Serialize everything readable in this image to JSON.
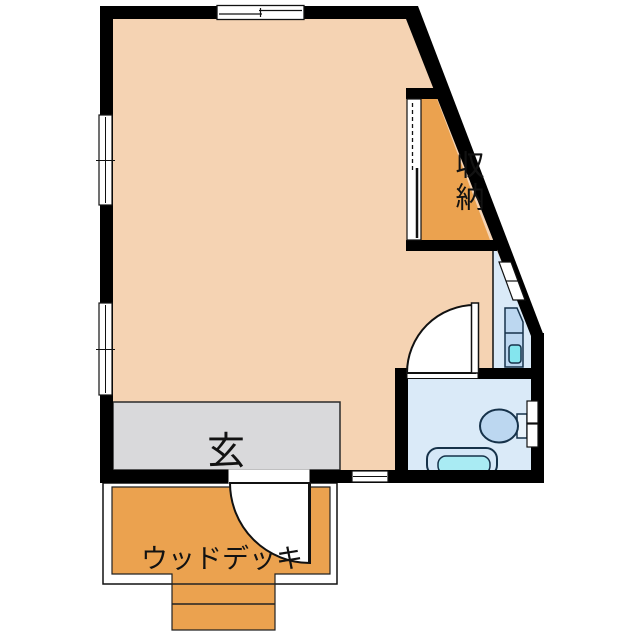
{
  "document": {
    "type": "floor-plan"
  },
  "labels": {
    "storage": "収納",
    "entrance": "玄",
    "wood_deck": "ウッドデッキ"
  },
  "colors": {
    "wall": "#000000",
    "outline": "#111111",
    "main_room": "#F5D3B3",
    "accent_orange": "#EBA24F",
    "entrance_floor": "#D9D9DB",
    "wet_area": "#DAEAF8",
    "fixture_fill": "#BCD7F0",
    "fixture_light": "#E9F3FB",
    "tub_fill": "#D5E7F7",
    "tub_inner": "#A9EBF3",
    "faucet": "#84E5EE",
    "fixture_stroke": "#16324A"
  }
}
